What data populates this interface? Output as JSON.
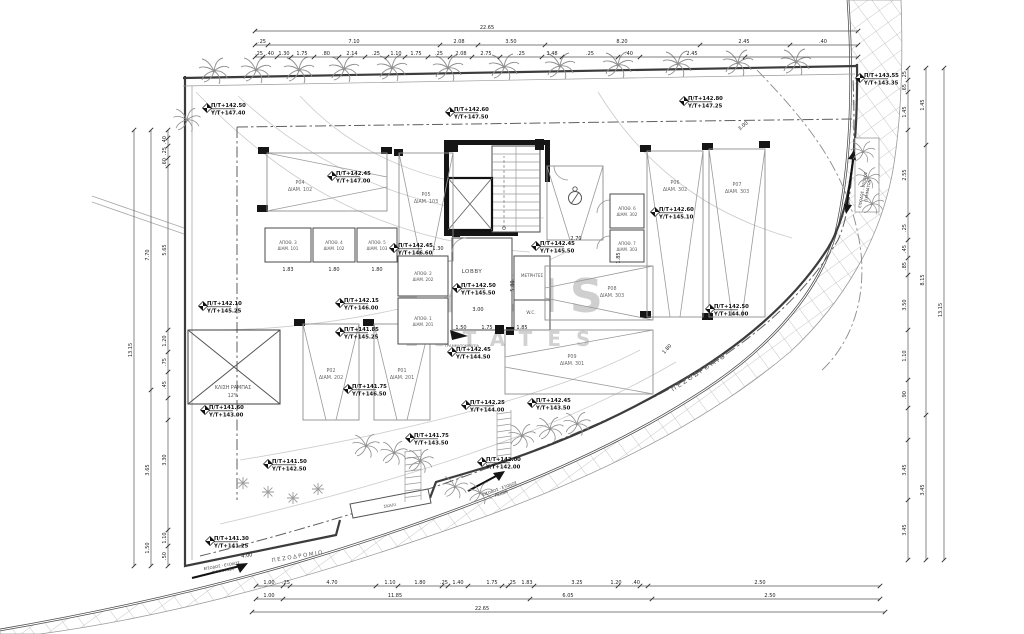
{
  "texts": {
    "watermark1": "KADIS",
    "watermark2": "ESTATES",
    "lobby": "LOBBY",
    "meters": "ΜΕΤΡΗΤΕΣ",
    "wc": "W.C.",
    "mailboxes": "ΓΡΑΜΜΑΤΟΚΙΒΩΤΙΑ",
    "ramp1": "ΚΛΙΣΗ ΡΑΜΠΑΣ",
    "ramp2": "12%",
    "sidewalk_a": "ΠΕΖΟΔΡΟΜΙΟ",
    "sidewalk_b": "ΠΕΖΟΔΡΟΜΙΟ",
    "entry": "ΕΙΣΟΔΟΣ - ΕΞΟΔΟΣ",
    "vehicles": "ΟΧΗΜΑΤΩΝ",
    "pedestrians": "ΠΕΖΩΝ",
    "step": "ΣΚΑΛΙ"
  },
  "colors": {
    "ink": "#3c3c3c",
    "light_line": "#9a9a9a",
    "hatch": "#b8b8b8",
    "watermark": "#8f8f8f",
    "black": "#151515",
    "background": "#ffffff"
  },
  "markers": [
    {
      "x": 207,
      "y": 108,
      "pt": "Π/Τ+142.50",
      "yt": "Υ/Τ+147.40"
    },
    {
      "x": 450,
      "y": 112,
      "pt": "Π/Τ+142.60",
      "yt": "Υ/Τ+147.50"
    },
    {
      "x": 684,
      "y": 101,
      "pt": "Π/Τ+142.80",
      "yt": "Υ/Τ+147.25"
    },
    {
      "x": 860,
      "y": 78,
      "pt": "Π/Τ+143.55",
      "yt": "Υ/Τ+143.35"
    },
    {
      "x": 332,
      "y": 176,
      "pt": "Π/Τ+142.45",
      "yt": "Υ/Τ+147.00"
    },
    {
      "x": 655,
      "y": 212,
      "pt": "Π/Τ+142.60",
      "yt": "Υ/Τ+145.10"
    },
    {
      "x": 394,
      "y": 248,
      "pt": "Π/Τ+142.45",
      "yt": "Υ/Τ+146.60"
    },
    {
      "x": 536,
      "y": 246,
      "pt": "Π/Τ+142.45",
      "yt": "Υ/Τ+145.50"
    },
    {
      "x": 457,
      "y": 288,
      "pt": "Π/Τ+142.50",
      "yt": "Υ/Τ+145.50"
    },
    {
      "x": 203,
      "y": 306,
      "pt": "Π/Τ+142.10",
      "yt": "Υ/Τ+145.25"
    },
    {
      "x": 340,
      "y": 303,
      "pt": "Π/Τ+142.15",
      "yt": "Υ/Τ+146.00"
    },
    {
      "x": 340,
      "y": 332,
      "pt": "Π/Τ+141.85",
      "yt": "Υ/Τ+145.25"
    },
    {
      "x": 205,
      "y": 410,
      "pt": "Π/Τ+141.60",
      "yt": "Υ/Τ+143.00"
    },
    {
      "x": 348,
      "y": 389,
      "pt": "Π/Τ+141.75",
      "yt": "Υ/Τ+146.50"
    },
    {
      "x": 268,
      "y": 464,
      "pt": "Π/Τ+141.50",
      "yt": "Υ/Τ+142.50"
    },
    {
      "x": 410,
      "y": 438,
      "pt": "Π/Τ+141.75",
      "yt": "Υ/Τ+143.50"
    },
    {
      "x": 452,
      "y": 352,
      "pt": "Π/Τ+142.45",
      "yt": "Υ/Τ+144.50"
    },
    {
      "x": 466,
      "y": 405,
      "pt": "Π/Τ+142.25",
      "yt": "Υ/Τ+144.00"
    },
    {
      "x": 532,
      "y": 403,
      "pt": "Π/Τ+142.45",
      "yt": "Υ/Τ+143.50"
    },
    {
      "x": 482,
      "y": 462,
      "pt": "Π/Τ+142.00",
      "yt": "Υ/Τ+142.00"
    },
    {
      "x": 710,
      "y": 309,
      "pt": "Π/Τ+142.50",
      "yt": "Υ/Τ+144.00"
    },
    {
      "x": 210,
      "y": 541,
      "pt": "Π/Τ+141.30",
      "yt": "Υ/Τ+141.25"
    }
  ],
  "stalls": [
    {
      "x": 267,
      "y": 153,
      "w": 120,
      "h": 58,
      "d": "r",
      "lx": 300,
      "ly": 184,
      "n": "P04",
      "a": "ΔΙΑΜ. 102"
    },
    {
      "x": 399,
      "y": 153,
      "w": 54,
      "h": 108,
      "d": "d",
      "lx": 426,
      "ly": 196,
      "n": "P05",
      "a": "ΔΙΑΜ. 103"
    },
    {
      "x": 647,
      "y": 151,
      "w": 56,
      "h": 166,
      "d": "d",
      "lx": 675,
      "ly": 184,
      "n": "P06",
      "a": "ΔΙΑΜ. 302"
    },
    {
      "x": 709,
      "y": 149,
      "w": 56,
      "h": 168,
      "d": "d",
      "lx": 737,
      "ly": 186,
      "n": "P07",
      "a": "ΔΙΑΜ. 303"
    },
    {
      "x": 303,
      "y": 324,
      "w": 56,
      "h": 96,
      "d": "d",
      "lx": 331,
      "ly": 372,
      "n": "P02",
      "a": "ΔΙΑΜ. 202"
    },
    {
      "x": 374,
      "y": 324,
      "w": 56,
      "h": 96,
      "d": "d",
      "lx": 402,
      "ly": 372,
      "n": "P01",
      "a": "ΔΙΑΜ. 201"
    },
    {
      "x": 545,
      "y": 266,
      "w": 108,
      "h": 54,
      "d": "l",
      "lx": 612,
      "ly": 290,
      "n": "P08",
      "a": "ΔΙΑΜ. 303"
    },
    {
      "x": 505,
      "y": 330,
      "w": 148,
      "h": 64,
      "d": "l",
      "lx": 572,
      "ly": 358,
      "n": "P09",
      "a": "ΔΙΑΜ. 301"
    }
  ],
  "storage": [
    {
      "x": 265,
      "y": 228,
      "w": 46,
      "h": 34,
      "n": "ΑΠΟΘ. 3",
      "a": "ΔΙΑΜ. 101"
    },
    {
      "x": 313,
      "y": 228,
      "w": 42,
      "h": 34,
      "n": "ΑΠΟΘ. 4",
      "a": "ΔΙΑΜ. 102"
    },
    {
      "x": 357,
      "y": 228,
      "w": 40,
      "h": 34,
      "n": "ΑΠΟΘ. 5",
      "a": "ΔΙΑΜ. 103"
    },
    {
      "x": 398,
      "y": 256,
      "w": 50,
      "h": 40,
      "n": "ΑΠΟΘ. 2",
      "a": "ΔΙΑΜ. 202"
    },
    {
      "x": 398,
      "y": 298,
      "w": 50,
      "h": 46,
      "n": "ΑΠΟΘ. 1",
      "a": "ΔΙΑΜ. 201"
    },
    {
      "x": 610,
      "y": 194,
      "w": 34,
      "h": 34,
      "n": "ΑΠΟΘ. 6",
      "a": "ΔΙΑΜ. 302"
    },
    {
      "x": 610,
      "y": 230,
      "w": 34,
      "h": 32,
      "n": "ΑΠΟΘ. 7",
      "a": "ΔΙΑΜ. 303"
    }
  ],
  "trees": {
    "palms": [
      [
        214,
        71,
        1
      ],
      [
        256,
        70,
        1
      ],
      [
        299,
        70,
        1
      ],
      [
        344,
        69,
        1
      ],
      [
        392,
        68,
        1
      ],
      [
        448,
        68,
        1
      ],
      [
        504,
        67,
        1
      ],
      [
        560,
        66,
        1
      ],
      [
        618,
        65,
        1
      ],
      [
        678,
        64,
        1
      ],
      [
        738,
        63,
        1
      ],
      [
        796,
        62,
        1
      ],
      [
        187,
        120,
        0.9
      ],
      [
        366,
        446,
        0.9
      ],
      [
        394,
        453,
        0.9
      ],
      [
        420,
        461,
        0.9
      ],
      [
        522,
        436,
        0.9
      ],
      [
        550,
        429,
        0.9
      ],
      [
        577,
        424,
        0.9
      ],
      [
        455,
        487,
        0.85
      ],
      [
        480,
        493,
        0.85
      ],
      [
        863,
        152,
        0.8
      ],
      [
        868,
        178,
        0.8
      ],
      [
        872,
        204,
        0.8
      ]
    ],
    "plants": [
      [
        243,
        483
      ],
      [
        268,
        492
      ],
      [
        293,
        498
      ],
      [
        318,
        489
      ]
    ]
  },
  "dims": {
    "chains": [
      {
        "dir": "h",
        "y": 31,
        "x1": 255,
        "x2": 858,
        "ticks": [
          255,
          858
        ],
        "labels": [
          {
            "p": 487,
            "v": "22.65"
          }
        ]
      },
      {
        "dir": "h",
        "y": 45,
        "x1": 255,
        "x2": 858,
        "ticks": [
          255,
          268,
          440,
          478,
          545,
          700,
          790,
          858
        ],
        "labels": [
          {
            "p": 262,
            "v": ".25"
          },
          {
            "p": 354,
            "v": "7.10"
          },
          {
            "p": 459,
            "v": "2.08"
          },
          {
            "p": 511,
            "v": "3.50"
          },
          {
            "p": 622,
            "v": "8.20"
          },
          {
            "p": 744,
            "v": "2.45"
          },
          {
            "p": 823,
            "v": ".40"
          }
        ]
      },
      {
        "dir": "h",
        "y": 57,
        "x1": 255,
        "x2": 858,
        "ticks": [
          255,
          263,
          277,
          291,
          314,
          339,
          365,
          387,
          405,
          428,
          450,
          472,
          500,
          542,
          562,
          618,
          640,
          745,
          858
        ],
        "labels": [
          {
            "p": 259,
            "v": ".25"
          },
          {
            "p": 270,
            "v": ".40"
          },
          {
            "p": 284,
            "v": "1.30"
          },
          {
            "p": 302,
            "v": "1.75"
          },
          {
            "p": 326,
            "v": ".80"
          },
          {
            "p": 352,
            "v": "2.14"
          },
          {
            "p": 376,
            "v": ".25"
          },
          {
            "p": 396,
            "v": "1.10"
          },
          {
            "p": 416,
            "v": "1.75"
          },
          {
            "p": 439,
            "v": ".25"
          },
          {
            "p": 461,
            "v": "2.08"
          },
          {
            "p": 486,
            "v": "2.75"
          },
          {
            "p": 521,
            "v": ".25"
          },
          {
            "p": 552,
            "v": "3.48"
          },
          {
            "p": 590,
            "v": ".25"
          },
          {
            "p": 629,
            "v": ".40"
          },
          {
            "p": 692,
            "v": "2.45"
          }
        ]
      },
      {
        "dir": "h",
        "y": 586,
        "x1": 256,
        "x2": 880,
        "ticks": [
          256,
          283,
          290,
          376,
          398,
          442,
          448,
          468,
          502,
          508,
          534,
          618,
          640,
          648,
          880
        ],
        "labels": [
          {
            "p": 269,
            "v": "1.00"
          },
          {
            "p": 286,
            "v": ".25"
          },
          {
            "p": 332,
            "v": "4.70"
          },
          {
            "p": 390,
            "v": "1.10"
          },
          {
            "p": 420,
            "v": "1.80"
          },
          {
            "p": 444,
            "v": ".25"
          },
          {
            "p": 458,
            "v": "1.40"
          },
          {
            "p": 492,
            "v": "1.75"
          },
          {
            "p": 512,
            "v": ".25"
          },
          {
            "p": 527,
            "v": "1.83"
          },
          {
            "p": 577,
            "v": "3.25"
          },
          {
            "p": 616,
            "v": "1.20"
          },
          {
            "p": 636,
            "v": ".40"
          },
          {
            "p": 760,
            "v": "2.50"
          }
        ]
      },
      {
        "dir": "h",
        "y": 599,
        "x1": 256,
        "x2": 880,
        "ticks": [
          256,
          283,
          530,
          652,
          880
        ],
        "labels": [
          {
            "p": 269,
            "v": "1.00"
          },
          {
            "p": 395,
            "v": "11.85"
          },
          {
            "p": 568,
            "v": "6.05"
          },
          {
            "p": 770,
            "v": "2.50"
          }
        ]
      },
      {
        "dir": "h",
        "y": 612,
        "x1": 252,
        "x2": 885,
        "ticks": [
          252,
          885
        ],
        "labels": [
          {
            "p": 482,
            "v": "22.65"
          }
        ]
      },
      {
        "dir": "v",
        "x": 168,
        "y1": 130,
        "y2": 566,
        "ticks": [
          130,
          138,
          146,
          158,
          166,
          330,
          352,
          372,
          398,
          420,
          530,
          546,
          566
        ],
        "labels": [
          {
            "p": 140,
            "v": ".40"
          },
          {
            "p": 151,
            "v": ".25"
          },
          {
            "p": 162,
            "v": ".60"
          },
          {
            "p": 250,
            "v": "5.65"
          },
          {
            "p": 341,
            "v": "1.20"
          },
          {
            "p": 362,
            "v": ".75"
          },
          {
            "p": 385,
            "v": ".45"
          },
          {
            "p": 460,
            "v": "3.30"
          },
          {
            "p": 538,
            "v": "1.10"
          },
          {
            "p": 556,
            "v": ".50"
          }
        ]
      },
      {
        "dir": "v",
        "x": 151,
        "y1": 130,
        "y2": 566,
        "ticks": [
          130,
          390,
          566
        ],
        "labels": [
          {
            "p": 255,
            "v": "7.70"
          },
          {
            "p": 470,
            "v": "3.65"
          },
          {
            "p": 548,
            "v": "1.50"
          }
        ]
      },
      {
        "dir": "v",
        "x": 134,
        "y1": 130,
        "y2": 566,
        "ticks": [
          130,
          566
        ],
        "labels": [
          {
            "p": 350,
            "v": "13.15"
          }
        ]
      },
      {
        "dir": "v",
        "x": 908,
        "y1": 68,
        "y2": 560,
        "ticks": [
          68,
          80,
          92,
          130,
          215,
          240,
          258,
          275,
          330,
          380,
          408,
          440,
          500,
          560
        ],
        "labels": [
          {
            "p": 75,
            "v": ".25"
          },
          {
            "p": 88,
            "v": ".65"
          },
          {
            "p": 112,
            "v": "1.45"
          },
          {
            "p": 175,
            "v": "2.55"
          },
          {
            "p": 228,
            "v": ".25"
          },
          {
            "p": 249,
            "v": ".45"
          },
          {
            "p": 266,
            "v": ".85"
          },
          {
            "p": 305,
            "v": "3.50"
          },
          {
            "p": 356,
            "v": "1.10"
          },
          {
            "p": 395,
            "v": ".90"
          },
          {
            "p": 470,
            "v": "3.45"
          },
          {
            "p": 530,
            "v": "3.45"
          }
        ]
      },
      {
        "dir": "v",
        "x": 926,
        "y1": 68,
        "y2": 560,
        "ticks": [
          68,
          145,
          415,
          560
        ],
        "labels": [
          {
            "p": 105,
            "v": "1.45"
          },
          {
            "p": 280,
            "v": "8.15"
          },
          {
            "p": 490,
            "v": "3.45"
          }
        ]
      },
      {
        "dir": "v",
        "x": 944,
        "y1": 68,
        "y2": 560,
        "ticks": [
          68,
          560
        ],
        "labels": [
          {
            "p": 310,
            "v": "13.15"
          }
        ]
      }
    ],
    "free": [
      {
        "x": 478,
        "y": 311,
        "v": "3.00"
      },
      {
        "x": 461,
        "y": 329,
        "v": "1.50"
      },
      {
        "x": 487,
        "y": 329,
        "v": "1.75"
      },
      {
        "x": 522,
        "y": 329,
        "v": "1.85"
      },
      {
        "x": 514,
        "y": 286,
        "v": "5.80",
        "r": -90
      },
      {
        "x": 288,
        "y": 271,
        "v": "1.83"
      },
      {
        "x": 334,
        "y": 271,
        "v": "1.80"
      },
      {
        "x": 377,
        "y": 271,
        "v": "1.80"
      },
      {
        "x": 576,
        "y": 240,
        "v": "2.70"
      },
      {
        "x": 744,
        "y": 127,
        "v": "3.00",
        "r": -40
      },
      {
        "x": 668,
        "y": 350,
        "v": "1.80",
        "r": -48
      },
      {
        "x": 247,
        "y": 557,
        "v": "4.00",
        "r": -9
      },
      {
        "x": 438,
        "y": 250,
        "v": "1.30"
      },
      {
        "x": 620,
        "y": 258,
        "v": "1.85",
        "r": -90
      }
    ]
  }
}
